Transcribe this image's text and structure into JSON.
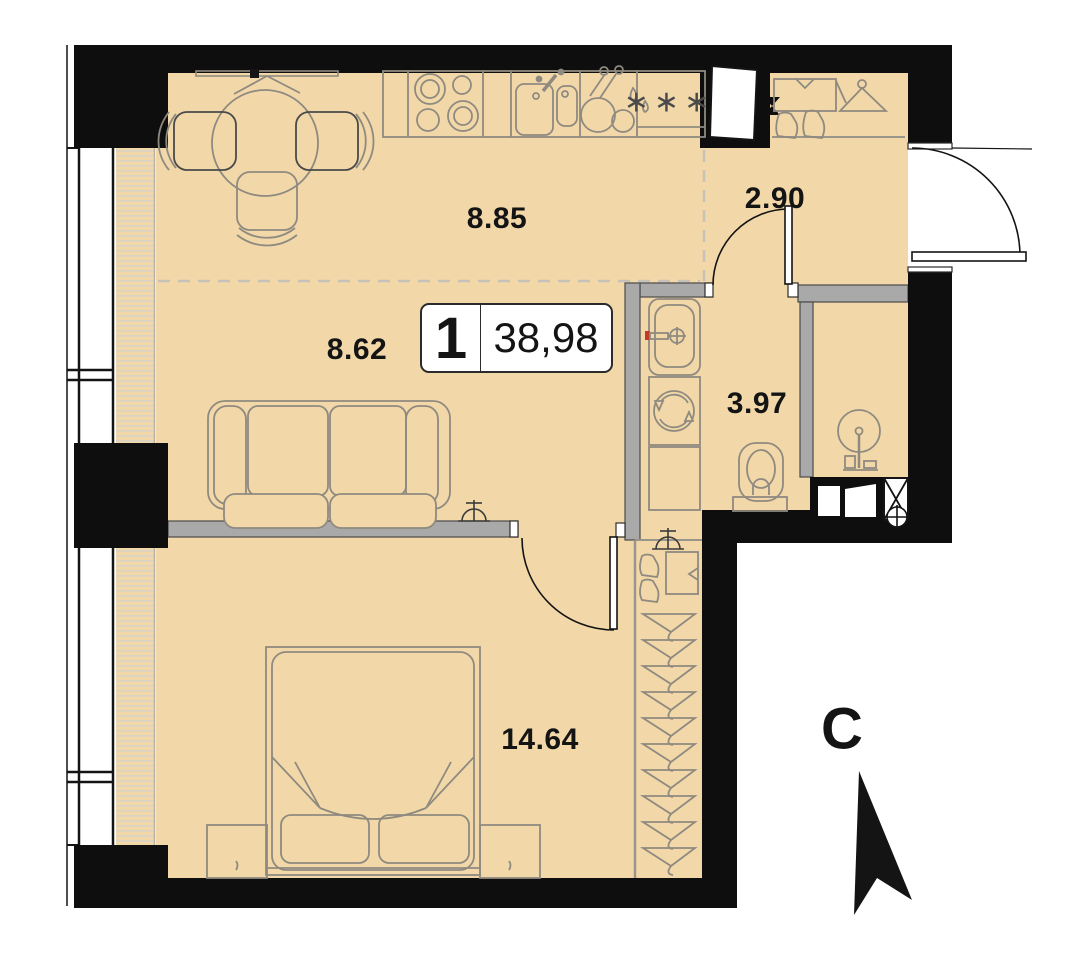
{
  "unit": {
    "rooms_count": "1",
    "total_area": "38,98"
  },
  "rooms": {
    "kitchen": {
      "name": "kitchen-dining",
      "area": "8.85"
    },
    "hallway": {
      "name": "hallway",
      "area": "2.90"
    },
    "living": {
      "name": "living-room",
      "area": "8.62"
    },
    "bathroom": {
      "name": "bathroom",
      "area": "3.97"
    },
    "bedroom": {
      "name": "bedroom",
      "area": "14.64"
    }
  },
  "compass": {
    "north_label": "С"
  },
  "symbols": {
    "fridge": "∗∗∗"
  },
  "colors": {
    "floor": "#f2d8a8",
    "walls": "#0e0e0e",
    "partitions": "#a9a9a9",
    "furniture_outline": "#8f8a80",
    "hot_water_marker": "#c0392b"
  }
}
